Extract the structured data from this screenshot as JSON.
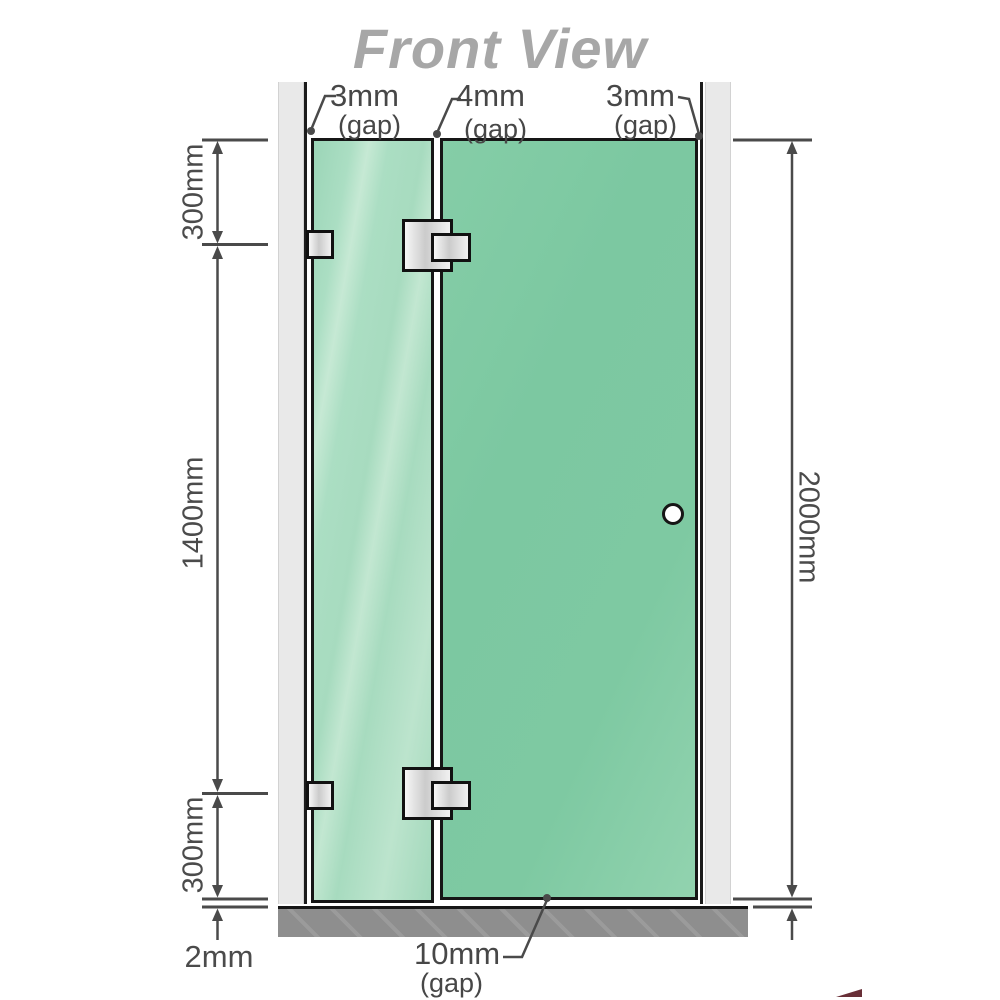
{
  "title": "Front View",
  "gaps": {
    "top_left": {
      "value": "3mm",
      "suffix": "(gap)"
    },
    "top_middle": {
      "value": "4mm",
      "suffix": "(gap)"
    },
    "top_right": {
      "value": "3mm",
      "suffix": "(gap)"
    },
    "bottom": {
      "value": "10mm",
      "suffix": "(gap)"
    }
  },
  "dimensions": {
    "left_top": "300mm",
    "left_middle": "1400mm",
    "left_bottom": "300mm",
    "floor_clearance": "2mm",
    "right_total": "2000mm"
  },
  "colors": {
    "glass_fixed_panel": "#a9dcc1",
    "glass_door": "#7cc8a2",
    "wall": "#e9e9e9",
    "floor_base": "#8e8e8e",
    "dimension_line": "#4a4a4a",
    "title_text": "#a7a7a7"
  }
}
